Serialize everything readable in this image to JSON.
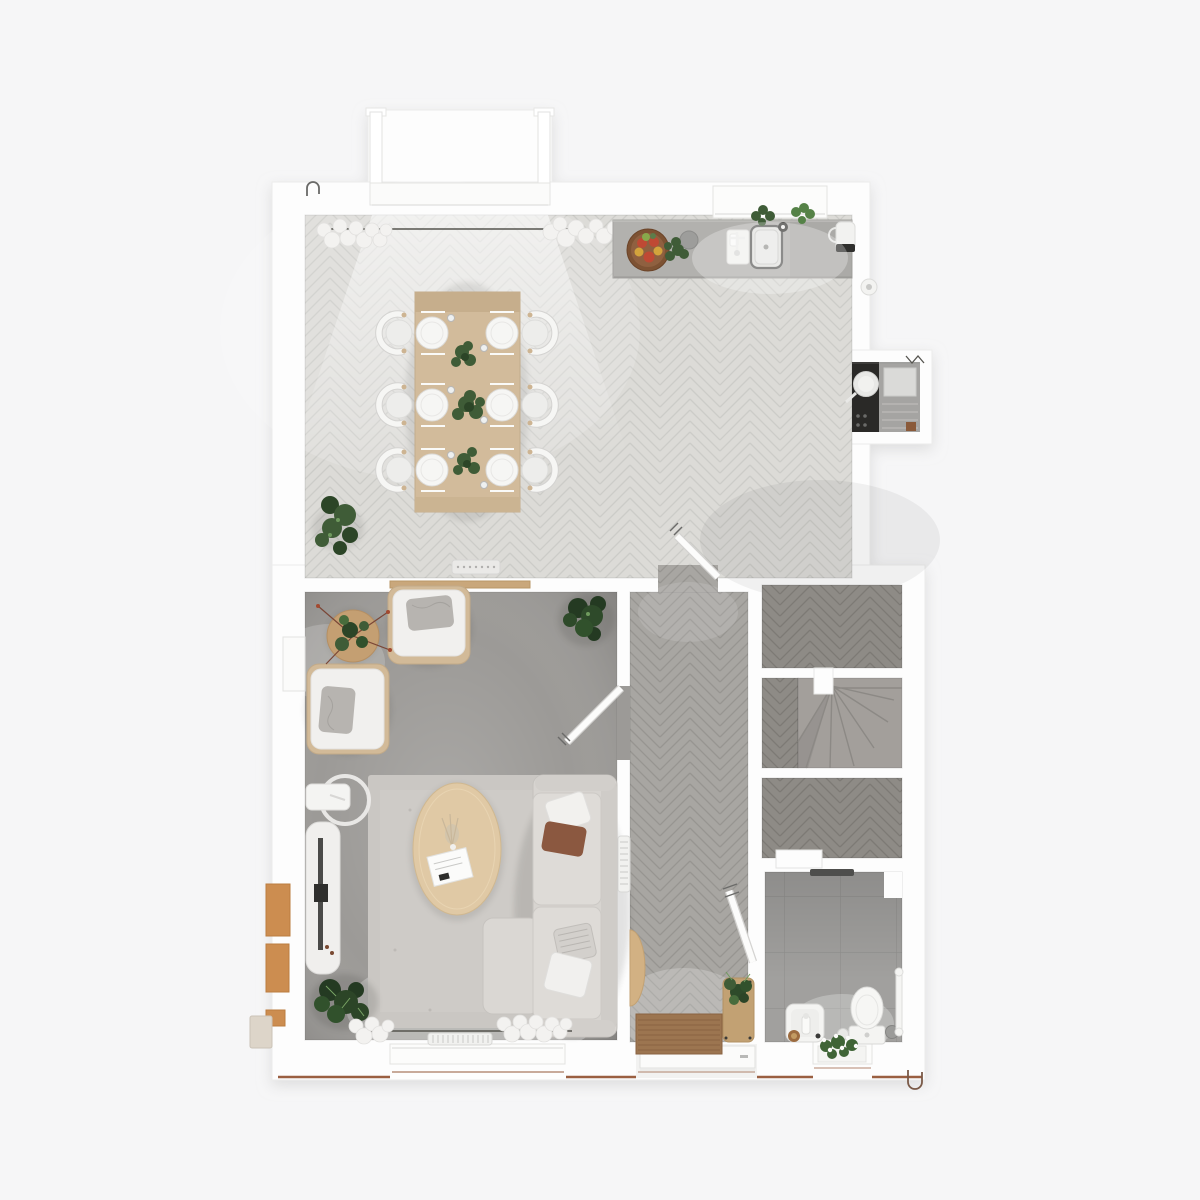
{
  "meta": {
    "type": "floor-plan-render",
    "view": "top-down dollhouse",
    "floor": "ground floor",
    "style": "photoreal 3D architectural visualization, no text labels"
  },
  "palette": {
    "page_bg": "#f6f6f7",
    "wall": "#fdfdfd",
    "wall_edge": "#ececeb",
    "floor_dining_base": "#dcdbd7",
    "floor_dining_seam": "#ccccc8",
    "floor_hall_base": "#a8a6a2",
    "floor_hall_seam": "#979591",
    "floor_closet_base": "#8e8b86",
    "floor_closet_seam": "#7d7a75",
    "bath_tile": "#a1a09e",
    "bath_grout": "#91908e",
    "living_floor": "#9c9a97",
    "rug": "#cac7c3",
    "stair_carpet": "#a39f9b",
    "counter": "#b2b1ae",
    "cooktop": "#2a2927",
    "wood_table": "#d2bb9b",
    "wood_coffee": "#e0c9a5",
    "wood_side": "#c49f72",
    "wood_bench": "#c2a173",
    "wood_shelf": "#c9a77b",
    "wood_console": "#d2b183",
    "doormat": "#9c7550",
    "sofa": "#d7d4d0",
    "pillow_rust": "#8b5840",
    "armchair_wood": "#d2ba98",
    "plant_dark": "#2c4527",
    "plant_mid": "#3f5c37",
    "plant_light": "#6f9a5e",
    "fruit_red": "#bf4934",
    "fruit_yellow": "#d3a33c",
    "brick": "#cc8d50",
    "base_trim": "#9a5f41",
    "fixture_white": "#f4f4f2"
  },
  "rooms": [
    {
      "id": "kitchen-dining",
      "name": "kitchen and dining room",
      "floor": "light herringbone wood"
    },
    {
      "id": "living-room",
      "name": "living room",
      "floor": "grey concrete with area rug"
    },
    {
      "id": "hallway",
      "name": "entrance hall",
      "floor": "grey herringbone wood"
    },
    {
      "id": "staircase",
      "name": "winder staircase",
      "floor": "grey carpet"
    },
    {
      "id": "store-upper",
      "name": "storage cupboard",
      "floor": "dark herringbone wood"
    },
    {
      "id": "store-lower",
      "name": "storage cupboard",
      "floor": "dark herringbone wood"
    },
    {
      "id": "bathroom",
      "name": "bathroom",
      "floor": "grey ceramic tiles"
    }
  ],
  "contents": {
    "kitchen_dining": [
      "bay window with curtains",
      "curtain rail",
      "dining table for six",
      "six white chairs",
      "place settings with plates and cutlery",
      "three table plants",
      "corner floor plant",
      "kitchen counter",
      "fruit bowl",
      "herb pots",
      "dish rack",
      "sink with tap",
      "kettle",
      "window over sink with herbs",
      "cooktop with pan",
      "oven cabinet niche",
      "floor vent"
    ],
    "living_room": [
      "two armchairs with cushions",
      "round side table with plant",
      "tall corner plant",
      "floor lamp",
      "media cabinet with TV",
      "area rug",
      "oval coffee table with magazine and pampas",
      "corner sofa with four cushions",
      "large floor plant",
      "rear window with curtains",
      "radiator",
      "side window",
      "wall shelf"
    ],
    "hallway": [
      "wall radiator",
      "half-round console table",
      "brown doormat",
      "bench with potted plant",
      "front door"
    ],
    "staircase": [
      "winder treads",
      "newel post block"
    ],
    "bathroom": [
      "wash basin with tap",
      "toilet",
      "toilet brush",
      "waste bin",
      "towel rail",
      "shower drain strip",
      "window with flowers"
    ]
  }
}
